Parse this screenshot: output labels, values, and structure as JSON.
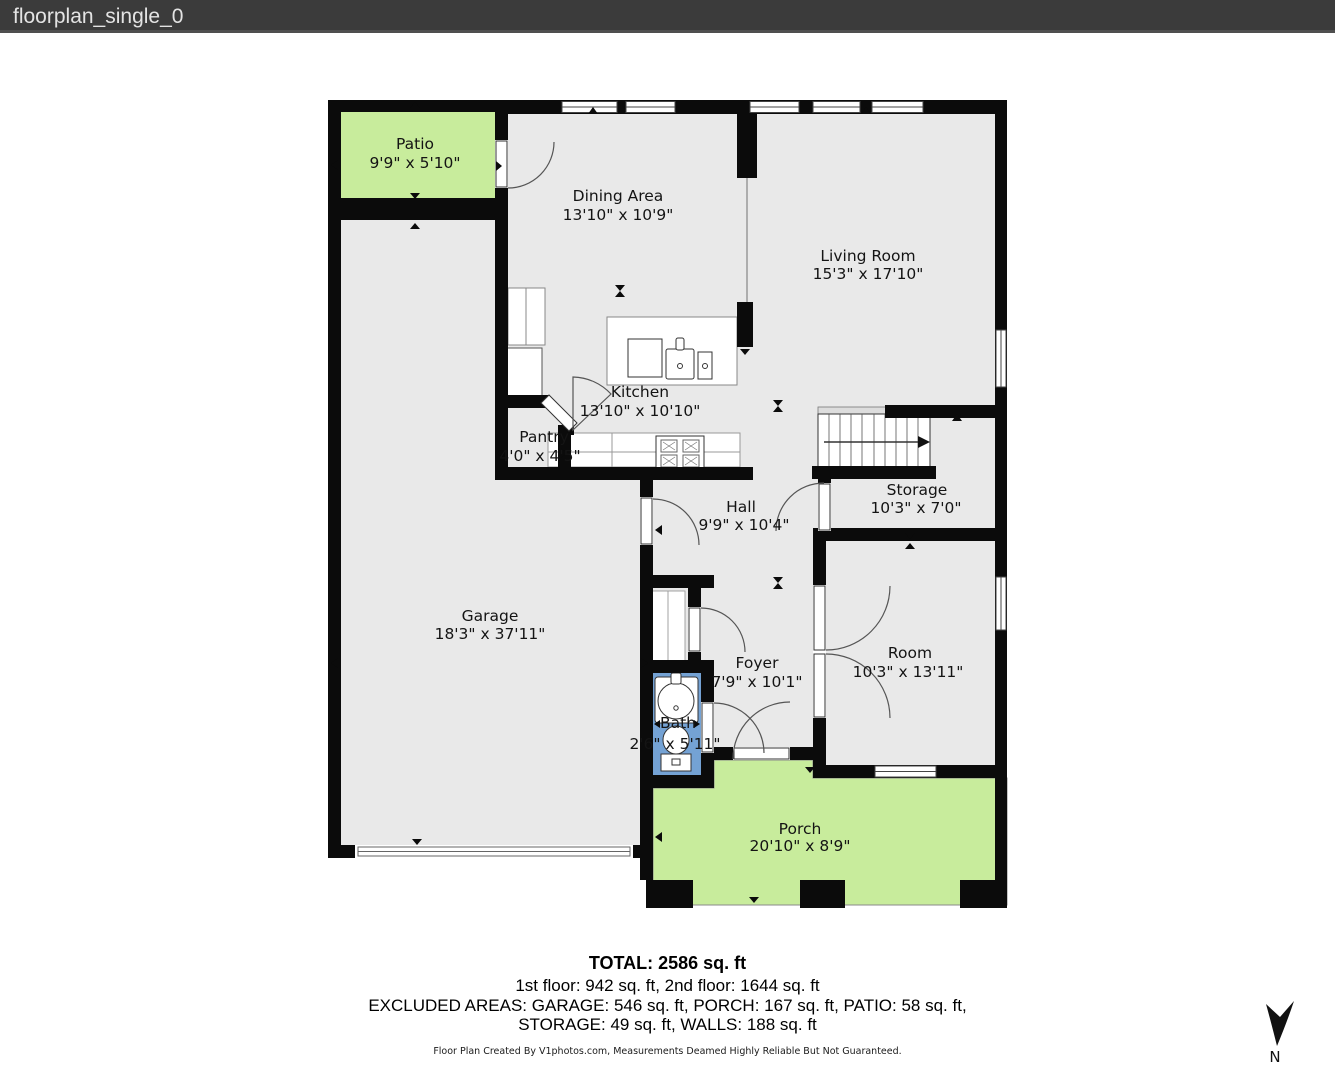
{
  "header": {
    "title": "floorplan_single_0"
  },
  "rooms": {
    "patio": {
      "name": "Patio",
      "dims": "9'9\" x 5'10\""
    },
    "dining": {
      "name": "Dining Area",
      "dims": "13'10\" x 10'9\""
    },
    "living": {
      "name": "Living Room",
      "dims": "15'3\" x 17'10\""
    },
    "kitchen": {
      "name": "Kitchen",
      "dims": "13'10\" x 10'10\""
    },
    "pantry": {
      "name": "Pantry",
      "dims": "4'0\" x 4'5\""
    },
    "hall": {
      "name": "Hall",
      "dims": "9'9\" x 10'4\""
    },
    "storage": {
      "name": "Storage",
      "dims": "10'3\" x 7'0\""
    },
    "garage": {
      "name": "Garage",
      "dims": "18'3\" x 37'11\""
    },
    "foyer": {
      "name": "Foyer",
      "dims": "7'9\" x 10'1\""
    },
    "room": {
      "name": "Room",
      "dims": "10'3\" x 13'11\""
    },
    "bath": {
      "name": "Bath",
      "dims": "2'6\" x 5'11\""
    },
    "porch": {
      "name": "Porch",
      "dims": "20'10\" x 8'9\""
    }
  },
  "summary": {
    "total": "TOTAL: 2586 sq. ft",
    "floors": "1st floor: 942 sq. ft, 2nd floor: 1644 sq. ft",
    "excluded1": "EXCLUDED AREAS: GARAGE: 546 sq. ft, PORCH: 167 sq. ft, PATIO: 58 sq. ft,",
    "excluded2": "STORAGE: 49 sq. ft, WALLS: 188 sq. ft"
  },
  "footer": {
    "credit": "Floor Plan Created By V1photos.com, Measurements Deamed Highly Reliable But Not Guaranteed."
  },
  "compass": {
    "label": "N"
  },
  "colors": {
    "header_bg": "#3b3b3b",
    "floor": "#e9e9e9",
    "outdoor": "#c8ec9c",
    "bath": "#74a2d4",
    "wall": "#0b0b0b"
  }
}
